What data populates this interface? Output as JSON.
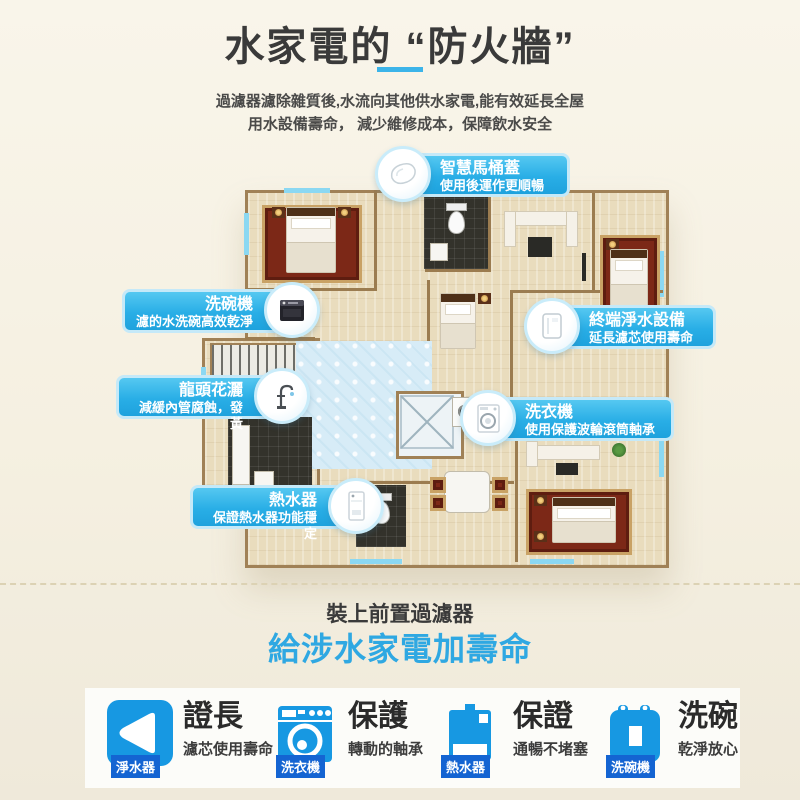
{
  "header": {
    "title": "水家電的 “防火牆”",
    "intro_line1": "過濾器濾除雜質後,水流向其他供水家電,能有效延長全屋",
    "intro_line2": "用水設備壽命， 減少維修成本，保障飲水安全"
  },
  "callouts": [
    {
      "id": "smart-toilet",
      "title": "智慧馬桶蓋",
      "subtitle": "使用後運作更順暢",
      "icon": "toilet-lid-icon"
    },
    {
      "id": "dishwasher",
      "title": "洗碗機",
      "subtitle": "濾的水洗碗高效乾淨",
      "icon": "dishwasher-icon"
    },
    {
      "id": "purifier",
      "title": "終端淨水設備",
      "subtitle": "延長濾芯使用壽命",
      "icon": "water-purifier-icon"
    },
    {
      "id": "faucet",
      "title": "龍頭花灑",
      "subtitle": "減緩內管腐蝕，發黃",
      "icon": "faucet-icon"
    },
    {
      "id": "washer",
      "title": "洗衣機",
      "subtitle": "使用保護波輪滾筒軸承",
      "icon": "washing-machine-icon"
    },
    {
      "id": "heater",
      "title": "熱水器",
      "subtitle": "保證熱水器功能穩定",
      "icon": "water-heater-icon"
    }
  ],
  "footer": {
    "line1": "裝上前置過濾器",
    "line2": "給涉水家電加壽命"
  },
  "cards": [
    {
      "badge": "淨水器",
      "title": "證長",
      "subtitle": "濾芯使用壽命",
      "icon": "filter-cartridge-icon"
    },
    {
      "badge": "洗衣機",
      "title": "保護",
      "subtitle": "轉動的軸承",
      "icon": "washing-machine-icon"
    },
    {
      "badge": "熱水器",
      "title": "保證",
      "subtitle": "通暢不堵塞",
      "icon": "water-heater-icon"
    },
    {
      "badge": "洗碗機",
      "title": "洗碗",
      "subtitle": "乾淨放心",
      "icon": "dishwasher-icon"
    }
  ],
  "colors": {
    "accent_blue": "#2fa8e2",
    "callout_blue": "#29aee6",
    "card_icon_blue": "#1798e2",
    "badge_blue": "#1464d2",
    "background_cream": "#f5f0e1",
    "underline_blue": "#3cb4e9"
  }
}
